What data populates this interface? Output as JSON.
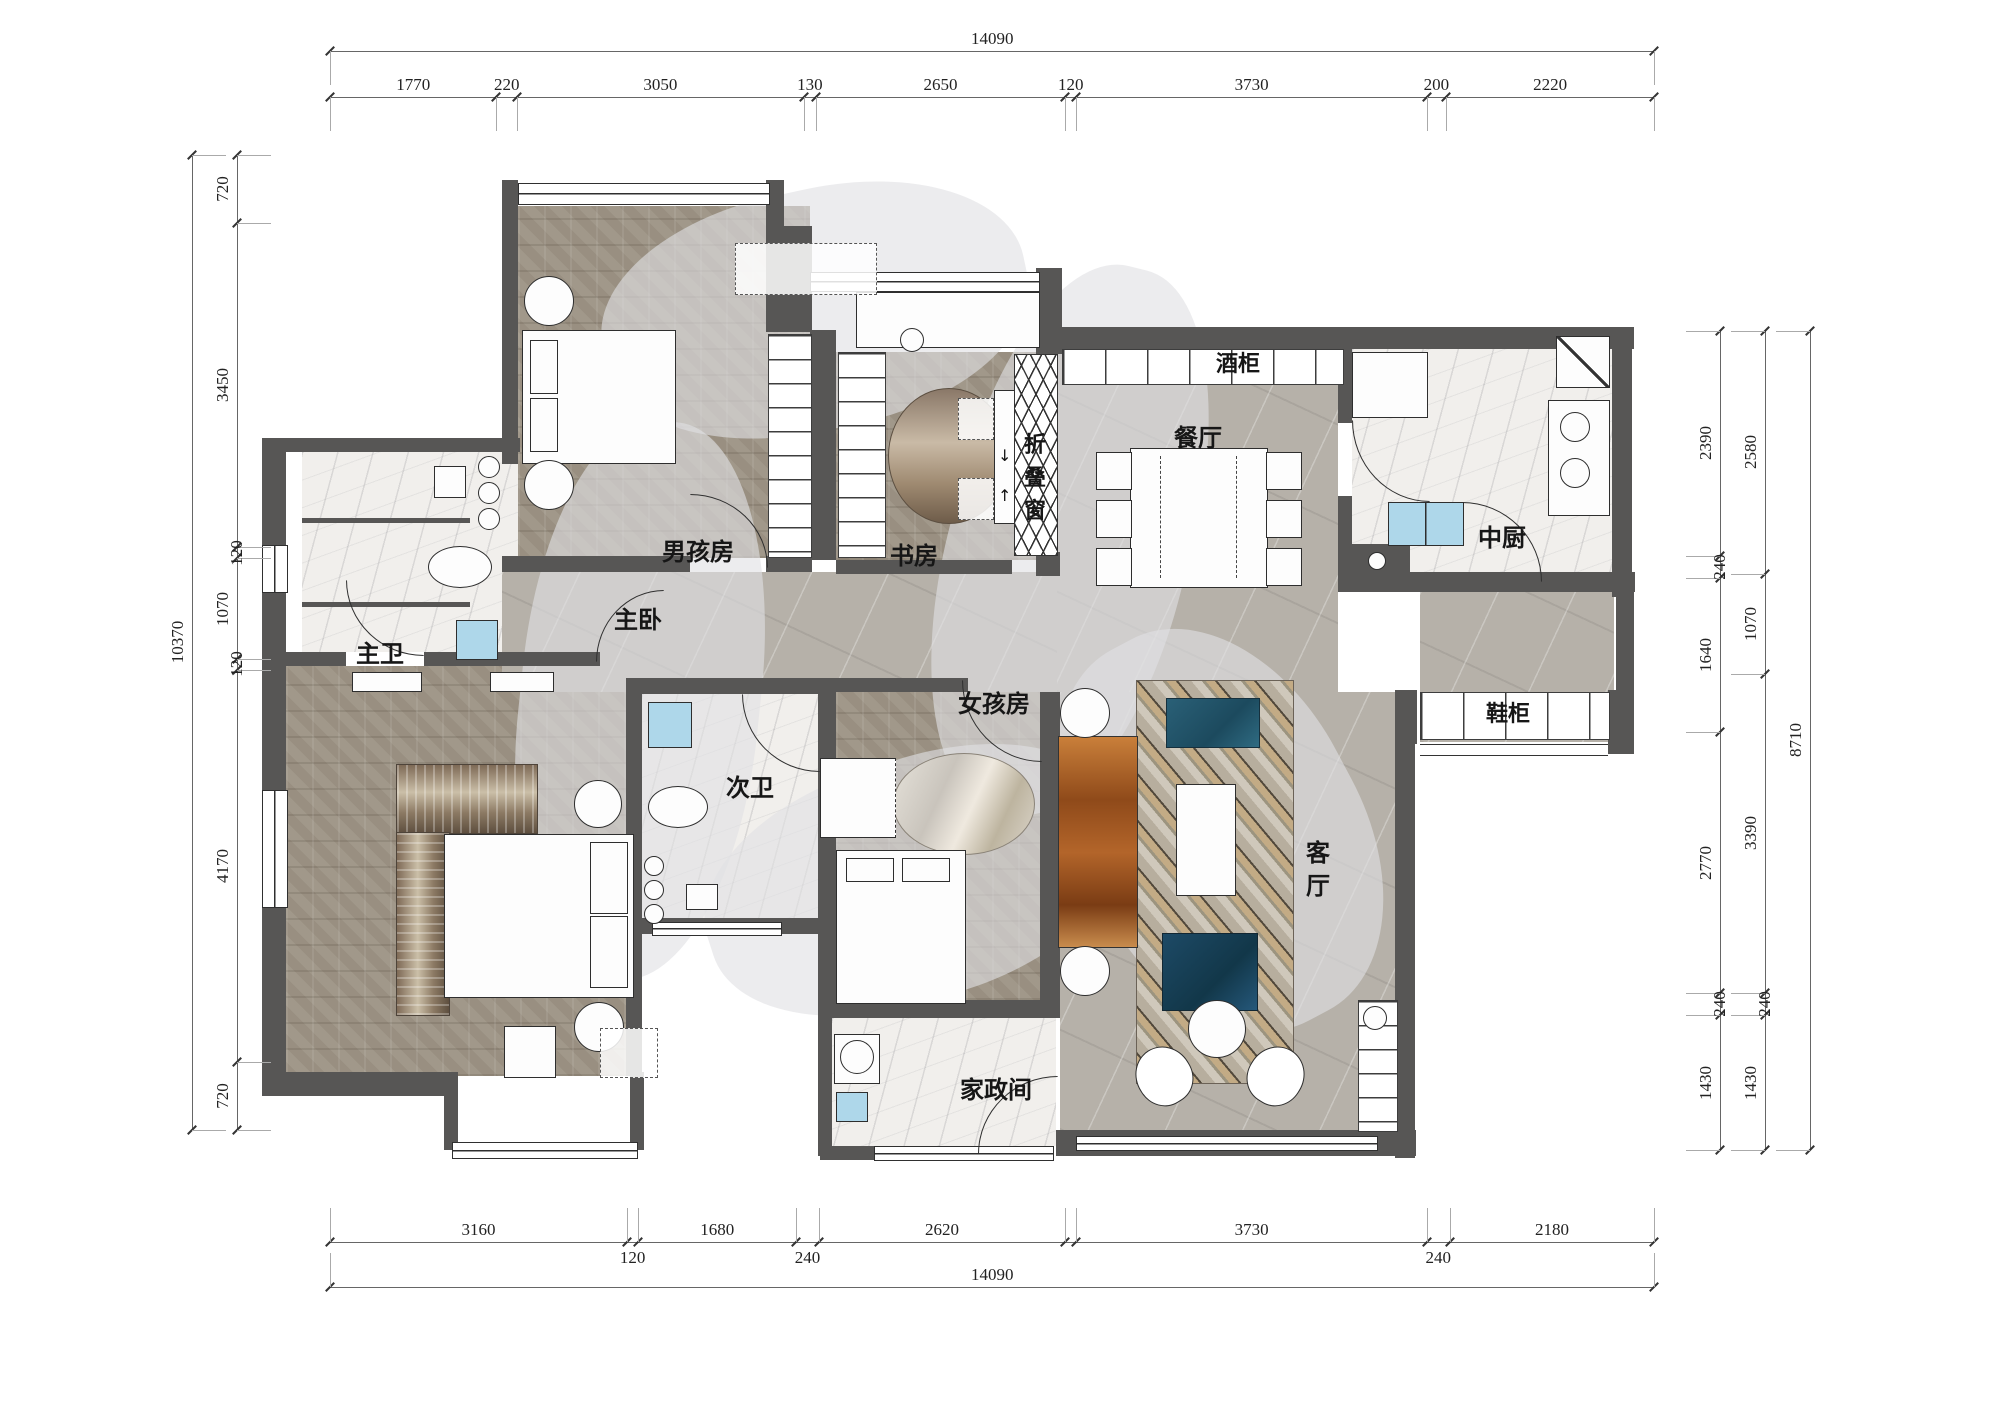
{
  "colors": {
    "wall": "#575655",
    "line": "#2f2f2f",
    "wood_floor": "#a29a8c",
    "gray_marble": "#b6b1a9",
    "white_marble": "#f1efec",
    "sink_blue": "#aed7ea",
    "tv_cabinet_rust": "#9c5520",
    "armchair_teal": "#2a6077",
    "armchair_navy": "#1d4a66"
  },
  "rooms": [
    {
      "id": "boys-room",
      "label": "男孩房"
    },
    {
      "id": "study",
      "label": "书房"
    },
    {
      "id": "folding-window",
      "label": "折叠窗"
    },
    {
      "id": "dining-room",
      "label": "餐厅"
    },
    {
      "id": "wine-cabinet",
      "label": "酒柜"
    },
    {
      "id": "kitchen",
      "label": "中厨"
    },
    {
      "id": "shoe-cabinet",
      "label": "鞋柜"
    },
    {
      "id": "living-room",
      "label": "客厅"
    },
    {
      "id": "girls-room",
      "label": "女孩房"
    },
    {
      "id": "housekeeping-room",
      "label": "家政间"
    },
    {
      "id": "second-bathroom",
      "label": "次卫"
    },
    {
      "id": "master-bathroom",
      "label": "主卫"
    },
    {
      "id": "master-bedroom",
      "label": "主卧"
    }
  ],
  "icons": {
    "fold_arrow_down": "↓",
    "fold_arrow_up": "↑"
  },
  "dims": {
    "px_per_mm": 0.094,
    "chains": [
      {
        "id": "top-total",
        "dir": "h",
        "x": 330,
        "y": 51,
        "guide": 1,
        "segments": [
          {
            "v": 14090,
            "label": "14090"
          }
        ]
      },
      {
        "id": "top-segments",
        "dir": "h",
        "x": 330,
        "y": 97,
        "guide": 1,
        "segments": [
          {
            "v": 1770,
            "label": "1770"
          },
          {
            "v": 220,
            "label": "220",
            "small": true
          },
          {
            "v": 3050,
            "label": "3050"
          },
          {
            "v": 130,
            "label": "130",
            "small": true
          },
          {
            "v": 2650,
            "label": "2650"
          },
          {
            "v": 120,
            "label": "120",
            "small": true
          },
          {
            "v": 3730,
            "label": "3730"
          },
          {
            "v": 200,
            "label": "200",
            "small": true
          },
          {
            "v": 2220,
            "label": "2220"
          }
        ]
      },
      {
        "id": "bottom-segments",
        "dir": "h",
        "x": 330,
        "y": 1242,
        "guide": -1,
        "small_below": true,
        "segments": [
          {
            "v": 3160,
            "label": "3160"
          },
          {
            "v": 120,
            "label": "120",
            "small": true
          },
          {
            "v": 1680,
            "label": "1680"
          },
          {
            "v": 240,
            "label": "240",
            "small": true
          },
          {
            "v": 2620,
            "label": "2620"
          },
          {
            "v": 120,
            "label": "",
            "small": true
          },
          {
            "v": 3730,
            "label": "3730"
          },
          {
            "v": 240,
            "label": "240",
            "small": true
          },
          {
            "v": 2180,
            "label": "2180"
          }
        ]
      },
      {
        "id": "bottom-total",
        "dir": "h",
        "x": 330,
        "y": 1287,
        "guide": -1,
        "segments": [
          {
            "v": 14090,
            "label": "14090"
          }
        ]
      },
      {
        "id": "left-segments",
        "dir": "v",
        "x": 237,
        "y": 155,
        "guide": 1,
        "segments": [
          {
            "v": 720,
            "label": "720"
          },
          {
            "v": 3450,
            "label": "3450"
          },
          {
            "v": 120,
            "label": "120",
            "small": true
          },
          {
            "v": 1070,
            "label": "1070"
          },
          {
            "v": 120,
            "label": "120",
            "small": true
          },
          {
            "v": 4170,
            "label": "4170"
          },
          {
            "v": 720,
            "label": "720"
          }
        ]
      },
      {
        "id": "left-total",
        "dir": "v",
        "x": 192,
        "y": 155,
        "guide": 1,
        "segments": [
          {
            "v": 10370,
            "label": "10370"
          }
        ]
      },
      {
        "id": "right-inner",
        "dir": "v",
        "x": 1720,
        "y": 331,
        "guide": -1,
        "segments": [
          {
            "v": 2390,
            "label": "2390"
          },
          {
            "v": 240,
            "label": "240",
            "small": true
          },
          {
            "v": 1640,
            "label": "1640"
          },
          {
            "v": 2770,
            "label": "2770"
          },
          {
            "v": 240,
            "label": "240",
            "small": true
          },
          {
            "v": 1430,
            "label": "1430"
          }
        ]
      },
      {
        "id": "right-middle",
        "dir": "v",
        "x": 1765,
        "y": 331,
        "guide": -1,
        "segments": [
          {
            "v": 2580,
            "label": "2580"
          },
          {
            "v": 1070,
            "label": "1070"
          },
          {
            "v": 3390,
            "label": "3390"
          },
          {
            "v": 240,
            "label": "240",
            "small": true
          },
          {
            "v": 1430,
            "label": "1430"
          }
        ]
      },
      {
        "id": "right-total",
        "dir": "v",
        "x": 1810,
        "y": 331,
        "guide": -1,
        "segments": [
          {
            "v": 8710,
            "label": "8710"
          }
        ]
      }
    ]
  }
}
